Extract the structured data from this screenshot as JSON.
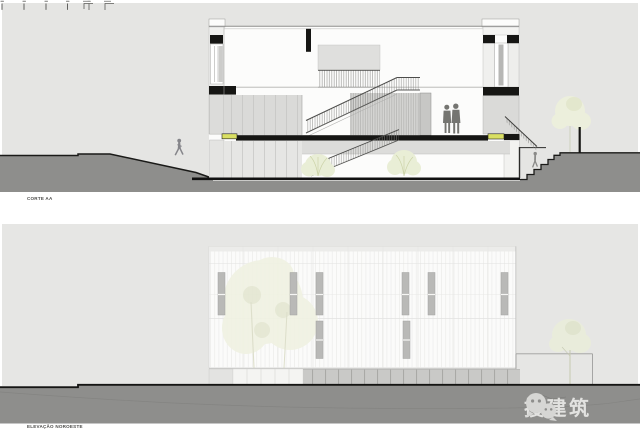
{
  "panels": {
    "section": {
      "label": "CORTE AA"
    },
    "elevation": {
      "label": "ELEVAÇÃO NOROESTE"
    }
  },
  "watermark": {
    "text": "搜建筑",
    "icon": "wechat-logo"
  },
  "palette": {
    "panel_bg": "#e5e5e3",
    "panel_bg2": "#e6e6e4",
    "ground": "#8e8e8c",
    "cut": "#161614",
    "wall": "#d8d8d6",
    "accent": "#d9df63",
    "plant": "#e9eed6",
    "facade": "#fbfbfa",
    "window": "#b9b9b7",
    "watermark": "#d6d6d4",
    "label": "#4b4b49"
  }
}
